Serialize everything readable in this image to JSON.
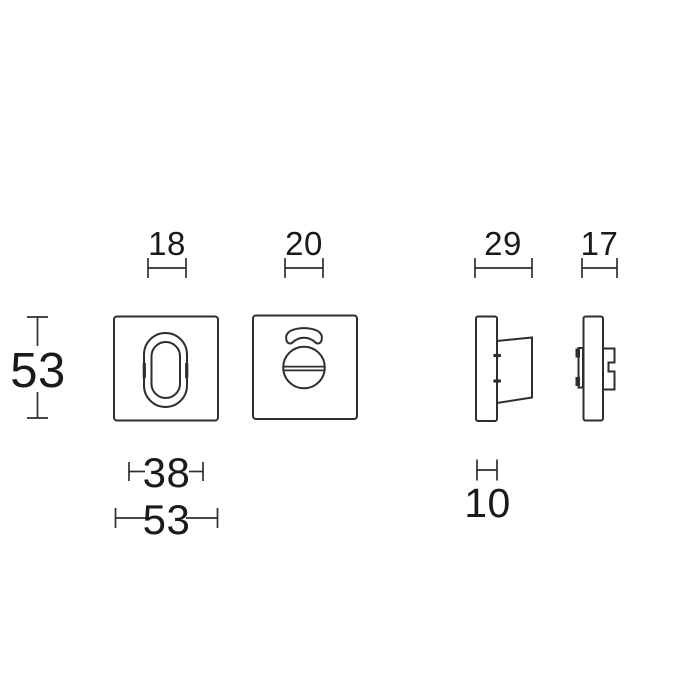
{
  "canvas": {
    "background": "#ffffff",
    "line_color": "#2e2e2e",
    "text_color": "#1a1a1a"
  },
  "dimensions": {
    "top": [
      {
        "id": "keyhole-width",
        "value": "18"
      },
      {
        "id": "turn-knob-width",
        "value": "20"
      },
      {
        "id": "knob-side-depth",
        "value": "29"
      },
      {
        "id": "clip-side-depth",
        "value": "17"
      }
    ],
    "left": [
      {
        "id": "rosette-height",
        "value": "53"
      }
    ],
    "bottom": [
      {
        "id": "inner-width",
        "value": "38"
      },
      {
        "id": "rosette-width",
        "value": "53"
      },
      {
        "id": "base-depth",
        "value": "10"
      }
    ]
  }
}
